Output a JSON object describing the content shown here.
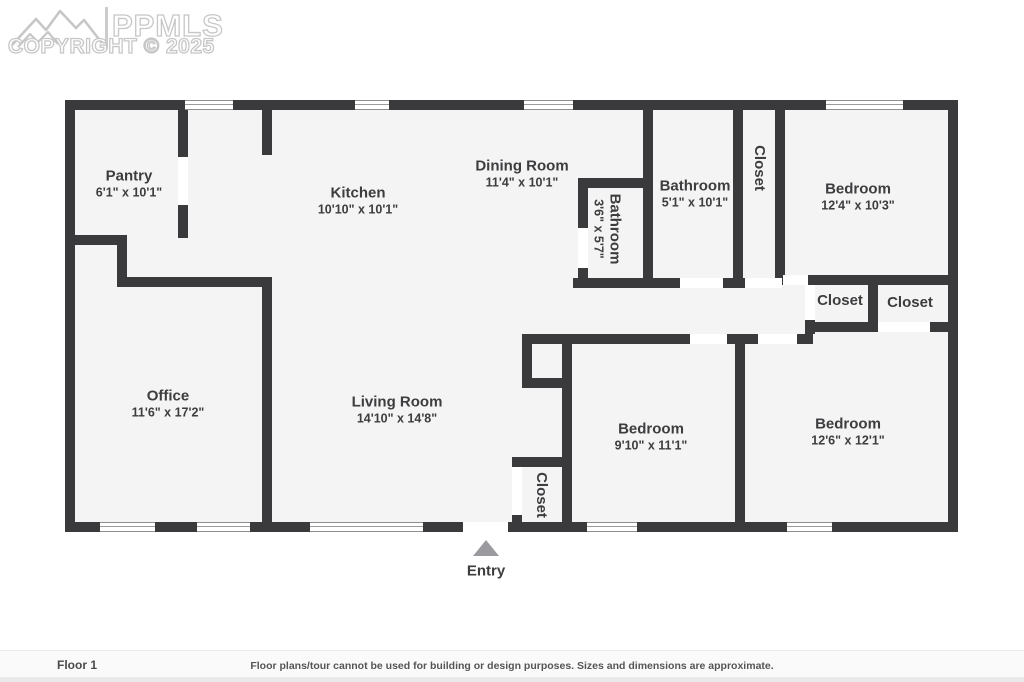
{
  "logo": {
    "brand": "PPMLS",
    "copyright": "COPYRIGHT © 2025"
  },
  "entry": {
    "label": "Entry"
  },
  "footer": {
    "floor_label": "Floor 1",
    "disclaimer": "Floor plans/tour cannot be used for building or design purposes. Sizes and dimensions are approximate."
  },
  "colors": {
    "wall": "#3a3a3c",
    "floor": "#f4f4f5",
    "label_text": "#3d3d3f",
    "logo_outline": "#c7c7c7",
    "entry_arrow": "#9b9b9f"
  },
  "floorplan": {
    "origin": {
      "x": 65,
      "y": 100
    },
    "size": {
      "w": 893,
      "h": 432
    },
    "wall_thickness": 10,
    "rooms": [
      {
        "name": "Pantry",
        "dims": "6'1\" x 10'1\"",
        "cx": 129,
        "cy": 184,
        "rotated": false
      },
      {
        "name": "Kitchen",
        "dims": "10'10\" x 10'1\"",
        "cx": 358,
        "cy": 201,
        "rotated": false
      },
      {
        "name": "Dining Room",
        "dims": "11'4\" x 10'1\"",
        "cx": 522,
        "cy": 174,
        "rotated": false
      },
      {
        "name": "Bathroom",
        "dims": "3'6\" x 5'7\"",
        "cx": 607,
        "cy": 229,
        "rotated": true
      },
      {
        "name": "Bathroom",
        "dims": "5'1\" x 10'1\"",
        "cx": 695,
        "cy": 194,
        "rotated": false
      },
      {
        "name": "Closet",
        "dims": "",
        "cx": 759,
        "cy": 168,
        "rotated": true
      },
      {
        "name": "Bedroom",
        "dims": "12'4\" x 10'3\"",
        "cx": 858,
        "cy": 197,
        "rotated": false
      },
      {
        "name": "Closet",
        "dims": "",
        "cx": 840,
        "cy": 301,
        "rotated": false
      },
      {
        "name": "Closet",
        "dims": "",
        "cx": 910,
        "cy": 303,
        "rotated": false
      },
      {
        "name": "Office",
        "dims": "11'6\" x 17'2\"",
        "cx": 168,
        "cy": 404,
        "rotated": false
      },
      {
        "name": "Living Room",
        "dims": "14'10\" x 14'8\"",
        "cx": 397,
        "cy": 410,
        "rotated": false
      },
      {
        "name": "Bedroom",
        "dims": "9'10\" x 11'1\"",
        "cx": 651,
        "cy": 437,
        "rotated": false
      },
      {
        "name": "Bedroom",
        "dims": "12'6\" x 12'1\"",
        "cx": 848,
        "cy": 432,
        "rotated": false
      },
      {
        "name": "Closet",
        "dims": "",
        "cx": 541,
        "cy": 495,
        "rotated": true
      }
    ],
    "walls": [
      [
        0,
        0,
        10,
        432
      ],
      [
        883,
        0,
        10,
        432
      ],
      [
        0,
        0,
        893,
        10
      ],
      [
        0,
        422,
        893,
        10
      ],
      [
        113,
        10,
        10,
        47
      ],
      [
        113,
        105,
        10,
        33
      ],
      [
        0,
        135,
        62,
        10
      ],
      [
        52,
        135,
        10,
        52
      ],
      [
        52,
        177,
        155,
        10
      ],
      [
        197,
        10,
        10,
        45
      ],
      [
        197,
        177,
        10,
        245
      ],
      [
        578,
        10,
        10,
        178
      ],
      [
        513,
        78,
        75,
        10
      ],
      [
        513,
        88,
        10,
        40
      ],
      [
        513,
        168,
        10,
        20
      ],
      [
        668,
        10,
        10,
        178
      ],
      [
        710,
        10,
        10,
        165
      ],
      [
        508,
        178,
        107,
        10
      ],
      [
        658,
        178,
        22,
        10
      ],
      [
        710,
        175,
        8,
        10
      ],
      [
        743,
        175,
        140,
        10
      ],
      [
        740,
        220,
        10,
        14
      ],
      [
        803,
        185,
        10,
        47
      ],
      [
        740,
        222,
        67,
        10
      ],
      [
        865,
        222,
        18,
        10
      ],
      [
        457,
        234,
        168,
        10
      ],
      [
        662,
        234,
        31,
        10
      ],
      [
        732,
        234,
        16,
        10
      ],
      [
        670,
        244,
        10,
        178
      ],
      [
        497,
        234,
        10,
        188
      ],
      [
        457,
        244,
        10,
        41
      ],
      [
        457,
        278,
        50,
        10
      ],
      [
        447,
        357,
        60,
        10
      ],
      [
        447,
        415,
        10,
        7
      ]
    ],
    "windows": [
      [
        120,
        0,
        48
      ],
      [
        290,
        0,
        34
      ],
      [
        459,
        0,
        49
      ],
      [
        761,
        0,
        77
      ],
      [
        35,
        422,
        55
      ],
      [
        132,
        422,
        53
      ],
      [
        245,
        422,
        113
      ],
      [
        522,
        422,
        50
      ],
      [
        722,
        422,
        45
      ]
    ],
    "door_gaps": [
      [
        113,
        57,
        10,
        48
      ],
      [
        513,
        128,
        10,
        40
      ],
      [
        615,
        178,
        43,
        10
      ],
      [
        680,
        178,
        37,
        10
      ],
      [
        718,
        175,
        25,
        10
      ],
      [
        740,
        185,
        10,
        35
      ],
      [
        813,
        222,
        52,
        10
      ],
      [
        625,
        234,
        37,
        10
      ],
      [
        693,
        234,
        39,
        10
      ],
      [
        447,
        367,
        10,
        48
      ],
      [
        398,
        422,
        45,
        10
      ]
    ],
    "entry_marker": {
      "cx": 486,
      "triangle_top": 540,
      "label_cy": 571
    }
  }
}
